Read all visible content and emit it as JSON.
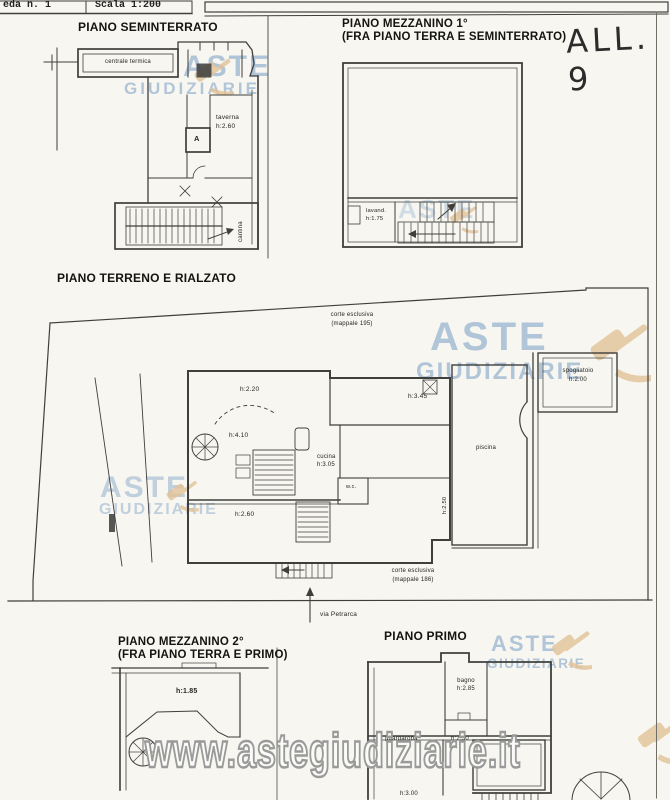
{
  "header": {
    "sheet": "eda n. 1",
    "scale": "Scala 1:200",
    "attachment": "ALL. 9"
  },
  "watermark": {
    "word1": "ASTE",
    "word2": "GIUDIZIARIE",
    "url": "www.astegiudiziarie.it"
  },
  "colors": {
    "ink": "#3f3f3c",
    "watermark_blue": "#789cc3",
    "gavel_tan": "#e3c398"
  },
  "sections": {
    "seminterrato": {
      "title": "PIANO SEMINTERRATO",
      "labels": {
        "centrale": "centrale termica",
        "taverna": "taverna",
        "taverna_h": "h:2.60",
        "room_a": "A",
        "cantina": "cantina"
      }
    },
    "mezzanino1": {
      "title_line1": "PIANO MEZZANINO 1°",
      "title_line2": "(FRA PIANO TERRA E SEMINTERRATO)",
      "labels": {
        "lavanderia": "lavand.",
        "lavanderia_h": "h:1.75"
      }
    },
    "terreno": {
      "title": "PIANO TERRENO E RIALZATO",
      "labels": {
        "corte_nord": "corte esclusiva",
        "corte_nord_mappale": "(mappale 195)",
        "h220": "h:2.20",
        "h345": "h:3.45",
        "h410": "h:4.10",
        "cucina": "cucina",
        "cucina_h": "h:3.05",
        "wc": "w.c.",
        "h260": "h:2.60",
        "piscina": "piscina",
        "piscina_h": "h:2.50",
        "spogliatoio": "spogliatoio",
        "spogliatoio_h": "h:2.00",
        "corte_sud": "corte esclusiva",
        "corte_sud_mappale": "(mappale 186)",
        "strada": "via Petrarca"
      }
    },
    "mezzanino2": {
      "title_line1": "PIANO MEZZANINO 2°",
      "title_line2": "(FRA PIANO TERRA E PRIMO)",
      "labels": {
        "h185": "h:1.85"
      }
    },
    "primo": {
      "title": "PIANO PRIMO",
      "labels": {
        "bagno": "bagno",
        "bagno_h": "h:2.85",
        "guardaroba": "guardaroba",
        "corridoio_h": "h:2.50",
        "h300": "h:3.00"
      }
    }
  }
}
